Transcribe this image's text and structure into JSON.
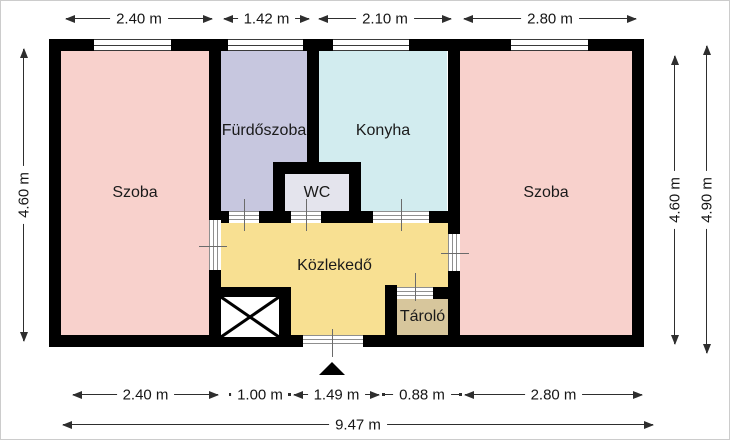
{
  "plan": {
    "wall_color": "#000000",
    "rooms": [
      {
        "id": "szoba-left",
        "label": "Szoba",
        "color": "#f8d1cc"
      },
      {
        "id": "furdoszoba",
        "label": "Fürdőszoba",
        "color": "#c7c7df"
      },
      {
        "id": "konyha",
        "label": "Konyha",
        "color": "#d2ecef"
      },
      {
        "id": "wc",
        "label": "WC",
        "color": "#e4e4ed"
      },
      {
        "id": "kozlekedo",
        "label": "Közlekedő",
        "color": "#f8e092"
      },
      {
        "id": "tarolo",
        "label": "Tároló",
        "color": "#d7c69c"
      },
      {
        "id": "szoba-right",
        "label": "Szoba",
        "color": "#f8d1cc"
      }
    ]
  },
  "dimensions": {
    "top": [
      "2.40 m",
      "1.42 m",
      "2.10 m",
      "2.80 m"
    ],
    "bottom": [
      "2.40 m",
      "1.00 m",
      "1.49 m",
      "0.88 m",
      "2.80 m"
    ],
    "total_width": "9.47 m",
    "left_height": "4.60 m",
    "right_inner_height": "4.60 m",
    "right_outer_height": "4.90 m"
  }
}
